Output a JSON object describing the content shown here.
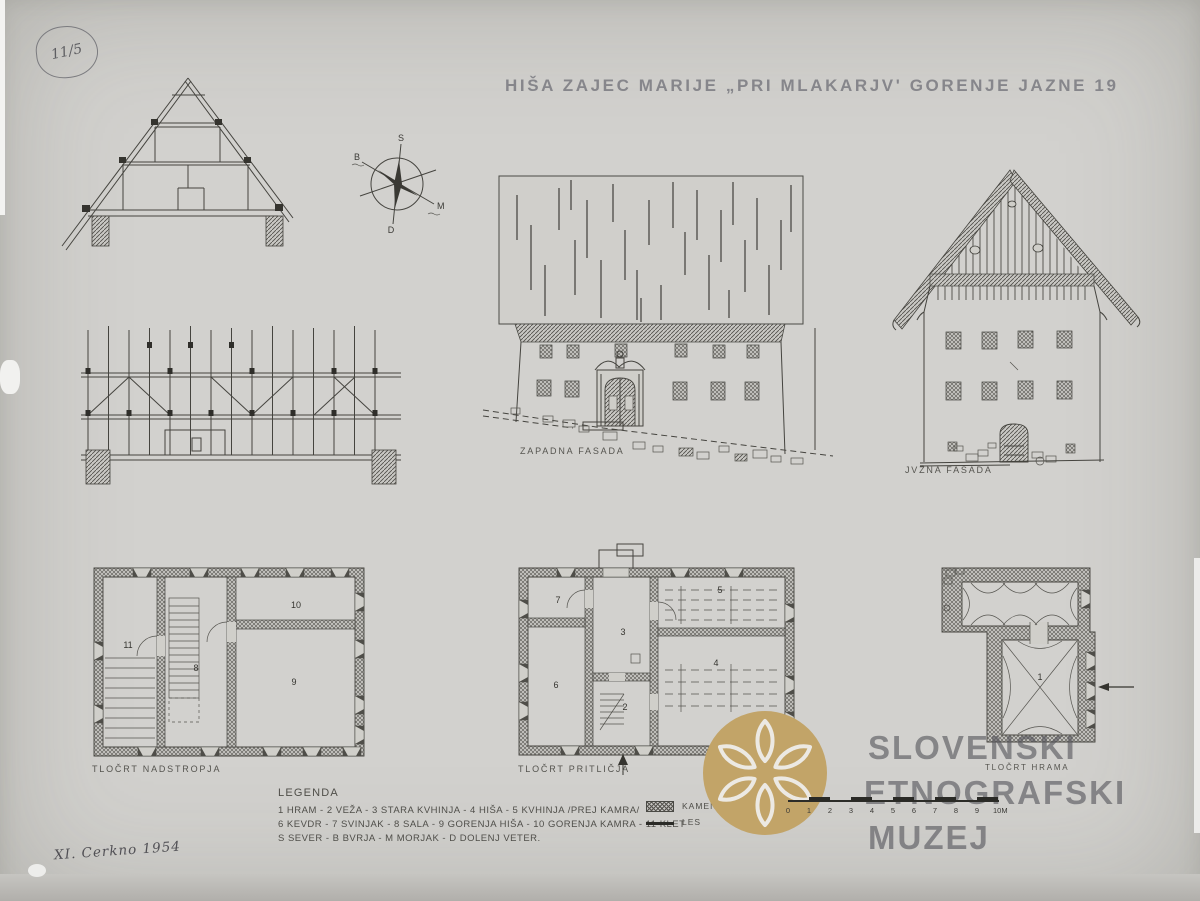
{
  "stamp": {
    "number": "11/5"
  },
  "title": "HIŠA ZAJEC MARIJE „PRI MLAKARJV' GORENJE JAZNE 19",
  "compass": {
    "north": "S",
    "burja": "B",
    "morjak": "M",
    "dolenj": "D"
  },
  "labels": {
    "west_facade": "ZAPADNA FASADA",
    "south_facade": "JVŽNA FASADA",
    "plan_upper": "TLOČRT NADSTROPJA",
    "plan_ground": "TLOČRT PRITLIČJA",
    "plan_hram": "TLOČRT HRAMA"
  },
  "rooms": {
    "upper": [
      "11",
      "8",
      "10",
      "9"
    ],
    "ground": [
      "7",
      "3",
      "5",
      "6",
      "2",
      "4"
    ],
    "hram": [
      "1"
    ]
  },
  "legend": {
    "title": "LEGENDA",
    "lines": [
      "1 HRAM - 2 VEŽA - 3 STARA KVHINJA - 4 HIŠA - 5 KVHINJA /PREJ KAMRA/",
      "6 KEVDR - 7 SVINJAK - 8 SALA - 9 GORENJA HIŠA - 10 GORENJA KAMRA - 11 KLET",
      "S SEVER - B BVRJA - M MORJAK - D DOLENJ VETER."
    ],
    "kamen": "KAMEN",
    "les": "LES"
  },
  "scalebar": {
    "ticks": [
      "0",
      "1",
      "2",
      "3",
      "4",
      "5",
      "6",
      "7",
      "8",
      "9",
      "10M"
    ]
  },
  "watermark": {
    "line1": "SLOVENSKI",
    "line2": "ETNOGRAFSKI",
    "line3": "MUZEJ",
    "accent": "#c2a468"
  },
  "note": "XI. Cerkno 1954"
}
